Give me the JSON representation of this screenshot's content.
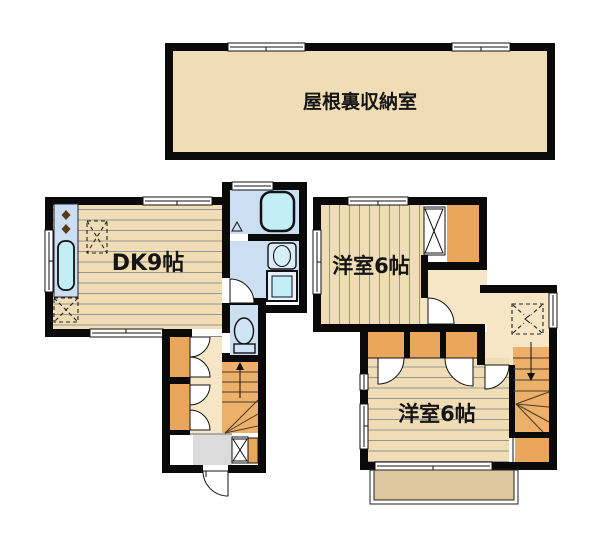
{
  "rooms": {
    "attic": {
      "label": "屋根裏収納室"
    },
    "dk": {
      "label": "DK9帖"
    },
    "bedroom_2f_front": {
      "label": "洋室6帖"
    },
    "bedroom_2f_back": {
      "label": "洋室6帖"
    }
  },
  "colors": {
    "background": "#ffffff",
    "wall": "#0a0a0a",
    "floor_tan": "#f1ddb5",
    "hall_tan": "#f6e6c6",
    "closet_orange": "#e9a65c",
    "stairs_orange": "#ecb06a",
    "wet_blue": "#cbdef2",
    "fixture_cyan": "#c3edf7",
    "genkan_gray": "#dbdbdb",
    "balcony_tan": "#dec69e"
  }
}
